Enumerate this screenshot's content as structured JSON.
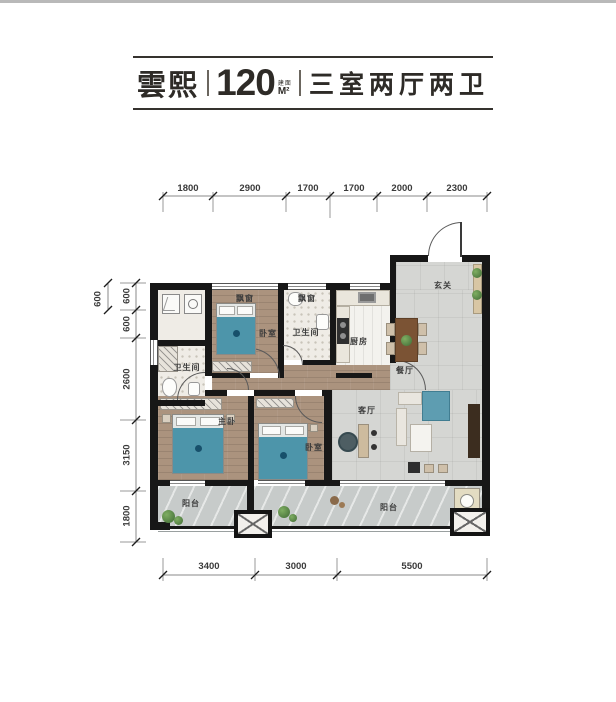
{
  "title": {
    "name": "雲熙",
    "area": "120",
    "area_unit_prefix": "建面",
    "area_unit": "M²",
    "layout_desc": "三室两厅两卫"
  },
  "rooms": {
    "bay1": "飘窗",
    "bay2": "飘窗",
    "bedroom_top": "卧室",
    "bath_mid": "卫生间",
    "bath_left": "卫生间",
    "kitchen": "厨房",
    "foyer": "玄关",
    "dining": "餐厅",
    "living": "客厅",
    "master": "主卧",
    "bedroom_bottom": "卧室",
    "balcony_left": "阳台",
    "balcony_right": "阳台"
  },
  "dims": {
    "top": [
      "1800",
      "2900",
      "1700",
      "1700",
      "2000",
      "2300"
    ],
    "left": [
      "600",
      "600",
      "2600",
      "3150",
      "1800"
    ],
    "left_outer": "600",
    "bottom": [
      "3400",
      "3000",
      "5500"
    ]
  },
  "colors": {
    "wall": "#171717",
    "wood_floor": "#ab937e",
    "tile_floor": "#d5d6d3",
    "balcony_floor": "#c7cbca",
    "bed_teal": "#4d95aa",
    "plant_green": "#4f7a40",
    "table_brown": "#7b5334",
    "title_ink": "#2e2b27"
  }
}
